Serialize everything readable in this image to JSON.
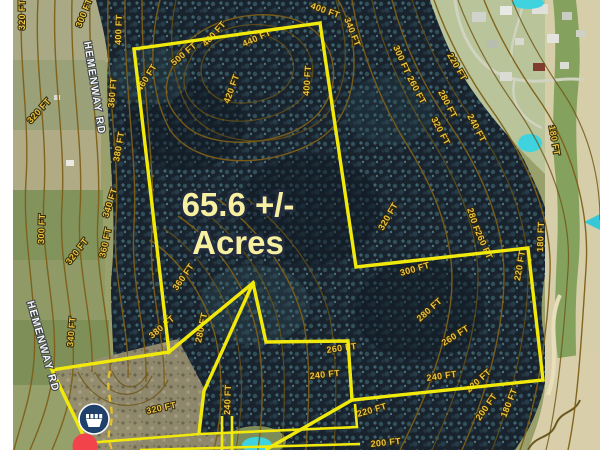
{
  "map": {
    "acreage_label": {
      "line1": "65.6 +/-",
      "line2": "Acres"
    },
    "road_labels": [
      {
        "text": "HEMENWAY RD",
        "x": 84,
        "y": 42,
        "rot": 81
      },
      {
        "text": "HEMENWAY RD",
        "x": 27,
        "y": 302,
        "rot": 74
      }
    ],
    "contour_unit": "FT",
    "contour_labels": [
      {
        "t": "320 FT",
        "x": 25,
        "y": 30,
        "r": -90
      },
      {
        "t": "300 FT",
        "x": 81,
        "y": 28,
        "r": -68
      },
      {
        "t": "400 FT",
        "x": 121,
        "y": 45,
        "r": -88
      },
      {
        "t": "460 FT",
        "x": 141,
        "y": 92,
        "r": -58
      },
      {
        "t": "360 FT",
        "x": 114,
        "y": 108,
        "r": -85
      },
      {
        "t": "320 FT",
        "x": 31,
        "y": 124,
        "r": -48
      },
      {
        "t": "380 FT",
        "x": 119,
        "y": 162,
        "r": -80
      },
      {
        "t": "340 FT",
        "x": 108,
        "y": 218,
        "r": -72
      },
      {
        "t": "300 FT",
        "x": 44,
        "y": 244,
        "r": -88
      },
      {
        "t": "320 FT",
        "x": 70,
        "y": 265,
        "r": -52
      },
      {
        "t": "360 FT",
        "x": 105,
        "y": 258,
        "r": -78
      },
      {
        "t": "500 FT",
        "x": 174,
        "y": 66,
        "r": -40
      },
      {
        "t": "480 FT",
        "x": 206,
        "y": 47,
        "r": -48
      },
      {
        "t": "440 FT",
        "x": 244,
        "y": 47,
        "r": -24
      },
      {
        "t": "420 FT",
        "x": 229,
        "y": 104,
        "r": -70
      },
      {
        "t": "400 FT",
        "x": 309,
        "y": 96,
        "r": -86
      },
      {
        "t": "400 FT",
        "x": 310,
        "y": 8,
        "r": 20
      },
      {
        "t": "340 FT",
        "x": 344,
        "y": 19,
        "r": 68
      },
      {
        "t": "300 FT",
        "x": 393,
        "y": 47,
        "r": 66
      },
      {
        "t": "260 FT",
        "x": 407,
        "y": 78,
        "r": 62
      },
      {
        "t": "220 FT",
        "x": 447,
        "y": 55,
        "r": 60
      },
      {
        "t": "280 FT",
        "x": 438,
        "y": 92,
        "r": 62
      },
      {
        "t": "320 FT",
        "x": 431,
        "y": 119,
        "r": 62
      },
      {
        "t": "240 FT",
        "x": 467,
        "y": 116,
        "r": 62
      },
      {
        "t": "180 FT",
        "x": 549,
        "y": 126,
        "r": 80
      },
      {
        "t": "280 FT",
        "x": 467,
        "y": 209,
        "r": 72
      },
      {
        "t": "260 FT",
        "x": 475,
        "y": 232,
        "r": 66
      },
      {
        "t": "220 FT",
        "x": 520,
        "y": 281,
        "r": -80
      },
      {
        "t": "180 FT",
        "x": 543,
        "y": 252,
        "r": -88
      },
      {
        "t": "320 FT",
        "x": 383,
        "y": 231,
        "r": -60
      },
      {
        "t": "300 FT",
        "x": 401,
        "y": 276,
        "r": -16
      },
      {
        "t": "280 FT",
        "x": 420,
        "y": 322,
        "r": -42
      },
      {
        "t": "260 FT",
        "x": 444,
        "y": 346,
        "r": -32
      },
      {
        "t": "240 FT",
        "x": 427,
        "y": 381,
        "r": -8
      },
      {
        "t": "220 FT",
        "x": 469,
        "y": 393,
        "r": -42
      },
      {
        "t": "200 FT",
        "x": 480,
        "y": 421,
        "r": -55
      },
      {
        "t": "180 FT",
        "x": 506,
        "y": 418,
        "r": -68
      },
      {
        "t": "220 FT",
        "x": 358,
        "y": 417,
        "r": -16
      },
      {
        "t": "200 FT",
        "x": 371,
        "y": 447,
        "r": -6
      },
      {
        "t": "260 FT",
        "x": 327,
        "y": 353,
        "r": -8
      },
      {
        "t": "240 FT",
        "x": 310,
        "y": 379,
        "r": -6
      },
      {
        "t": "280 FT",
        "x": 201,
        "y": 343,
        "r": -78
      },
      {
        "t": "240 FT",
        "x": 230,
        "y": 415,
        "r": -88
      },
      {
        "t": "320 FT",
        "x": 147,
        "y": 414,
        "r": -12
      },
      {
        "t": "380 FT",
        "x": 152,
        "y": 339,
        "r": -40
      },
      {
        "t": "340 FT",
        "x": 73,
        "y": 347,
        "r": -85
      },
      {
        "t": "360 FT",
        "x": 177,
        "y": 291,
        "r": -55
      }
    ],
    "markers": [
      {
        "name": "poi-marker",
        "glyph": "crown-basket",
        "x": 94,
        "y": 419
      },
      {
        "name": "location-dot",
        "glyph": "red-circle",
        "x": 85,
        "y": 446
      }
    ],
    "colors": {
      "parcel_yellow": "#f2e90c",
      "contour_brown": "#7d5f17",
      "contour_label_gold": "#edc53f",
      "acres_text": "#f6f0a0",
      "road_label_white": "#f5f5f5",
      "marker_blue": "#1c3e6b",
      "marker_red": "#f2434b",
      "pond_cyan": "#3ed3de"
    }
  }
}
